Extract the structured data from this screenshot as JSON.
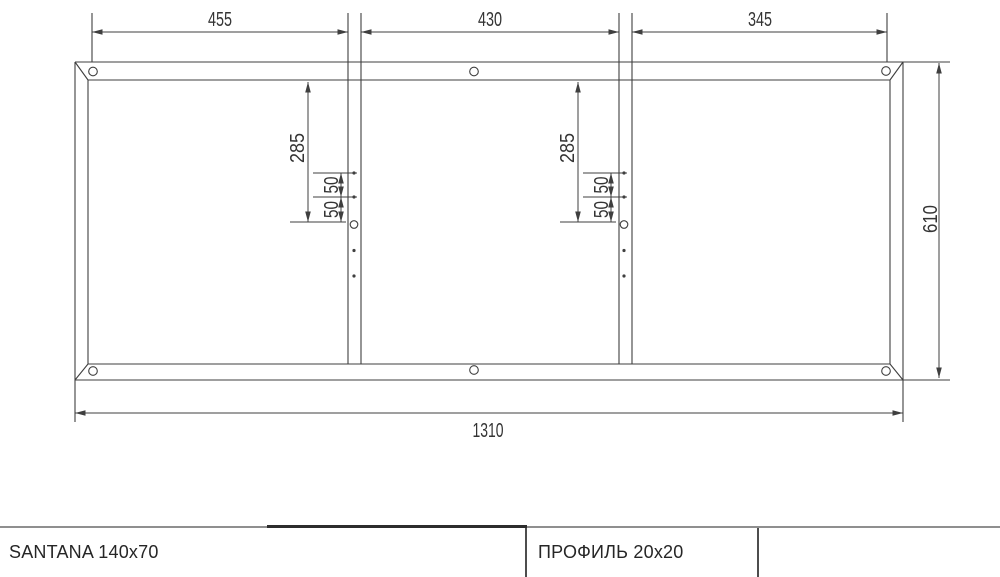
{
  "drawing": {
    "line_color": "#3f3f3f",
    "dims": {
      "top_segment_left": "455",
      "top_segment_center": "430",
      "top_segment_right": "345",
      "overall_width": "1310",
      "overall_height": "610",
      "left_drop": "285",
      "left_hole_spacing_upper": "50",
      "left_hole_spacing_lower": "50",
      "right_drop": "285",
      "right_hole_spacing_upper": "50",
      "right_hole_spacing_lower": "50"
    }
  },
  "title_block": {
    "model": "SANTANA 140x70",
    "profile": "ПРОФИЛЬ 20x20"
  }
}
